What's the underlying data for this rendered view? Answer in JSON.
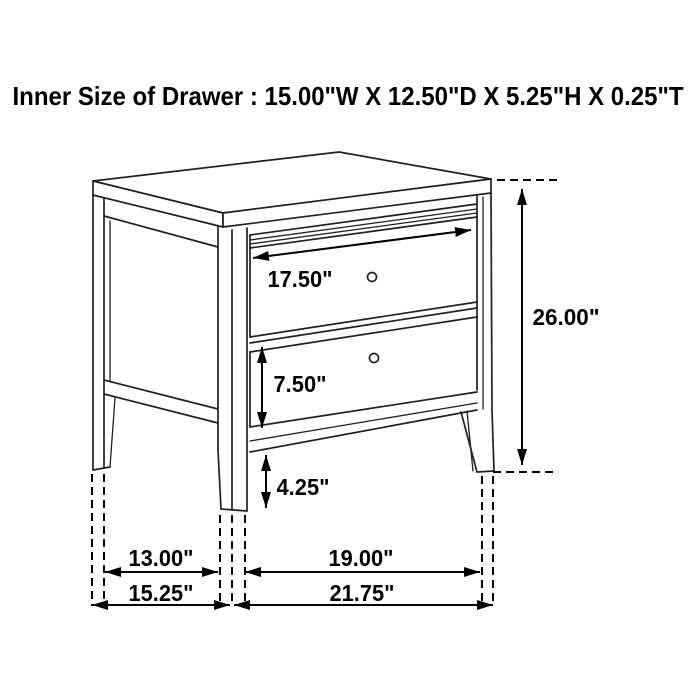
{
  "title": "Inner Size of Drawer : 15.00\"W X 12.50\"D X 5.25\"H X 0.25\"T",
  "dimensions": {
    "top_drawer_width": "17.50\"",
    "bottom_drawer_height": "7.50\"",
    "leg_clearance_height": "4.25\"",
    "overall_height": "26.00\"",
    "side_inner_depth": "13.00\"",
    "front_inner_width": "19.00\"",
    "overall_depth": "15.25\"",
    "overall_width": "21.75\""
  },
  "colors": {
    "background": "#ffffff",
    "outline": "#231f20",
    "dimension": "#000000"
  }
}
